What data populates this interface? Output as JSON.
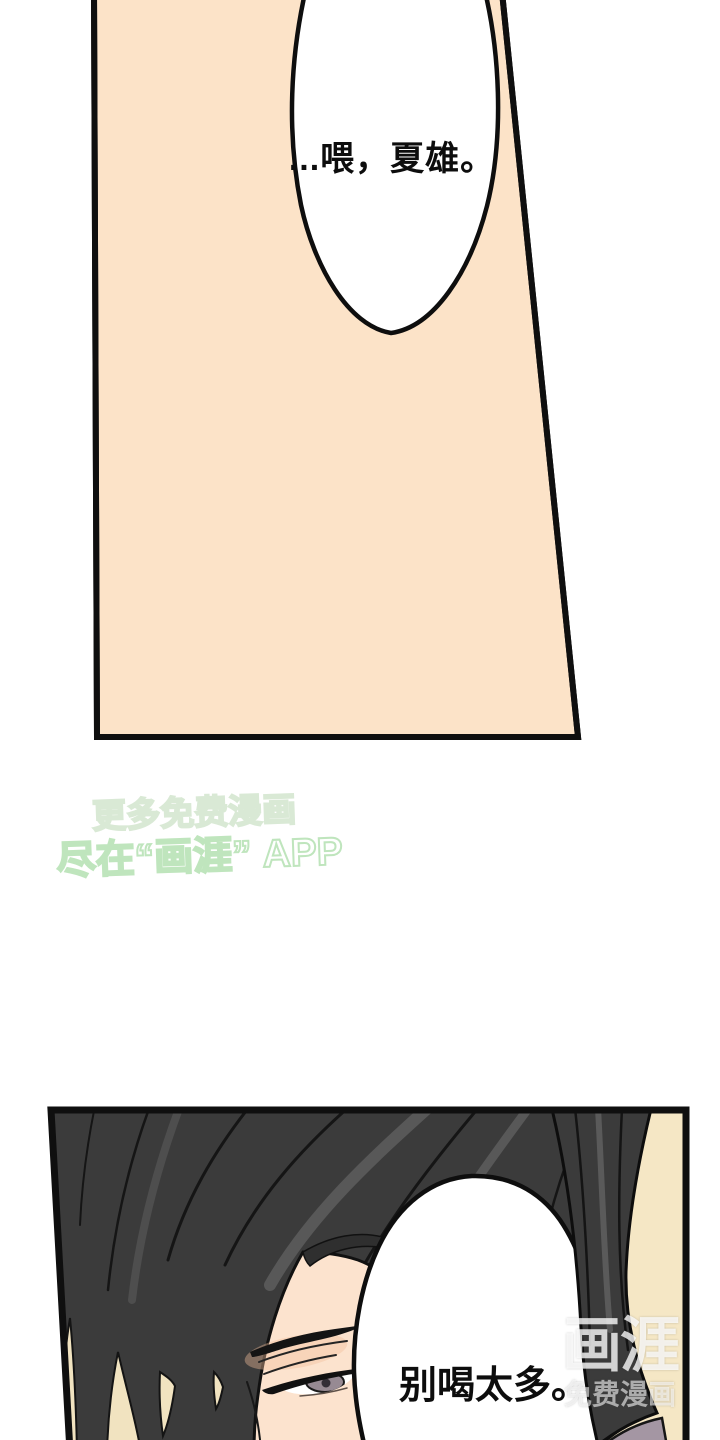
{
  "page": {
    "background": "#ffffff"
  },
  "top_panel": {
    "fill": "#FCE3C8",
    "border_color": "#0f0f0f",
    "bubble_fill": "#ffffff",
    "bubble_text": "...喂，夏雄。"
  },
  "promo_watermark": {
    "line1": "更多免费漫画",
    "line2": "尽在“画涯” APP",
    "line1_stroke": "#d9e9d5",
    "line2_stroke": "#bfe5bd"
  },
  "bottom_panel": {
    "fill": "#F5E7C5",
    "border_color": "#0f0f0f",
    "hair_color": "#3B3B3B",
    "skin_color": "#FCE3CE",
    "blush_color": "#F3BE9B",
    "iris_color": "#978A93",
    "clothing_color": "#A496A3",
    "bubble_fill": "#ffffff",
    "bubble_text": "别喝太多。"
  },
  "brand_watermark": {
    "name": "画涯",
    "tagline": "免费漫画",
    "text_color": "rgba(255,255,255,0.78)"
  }
}
